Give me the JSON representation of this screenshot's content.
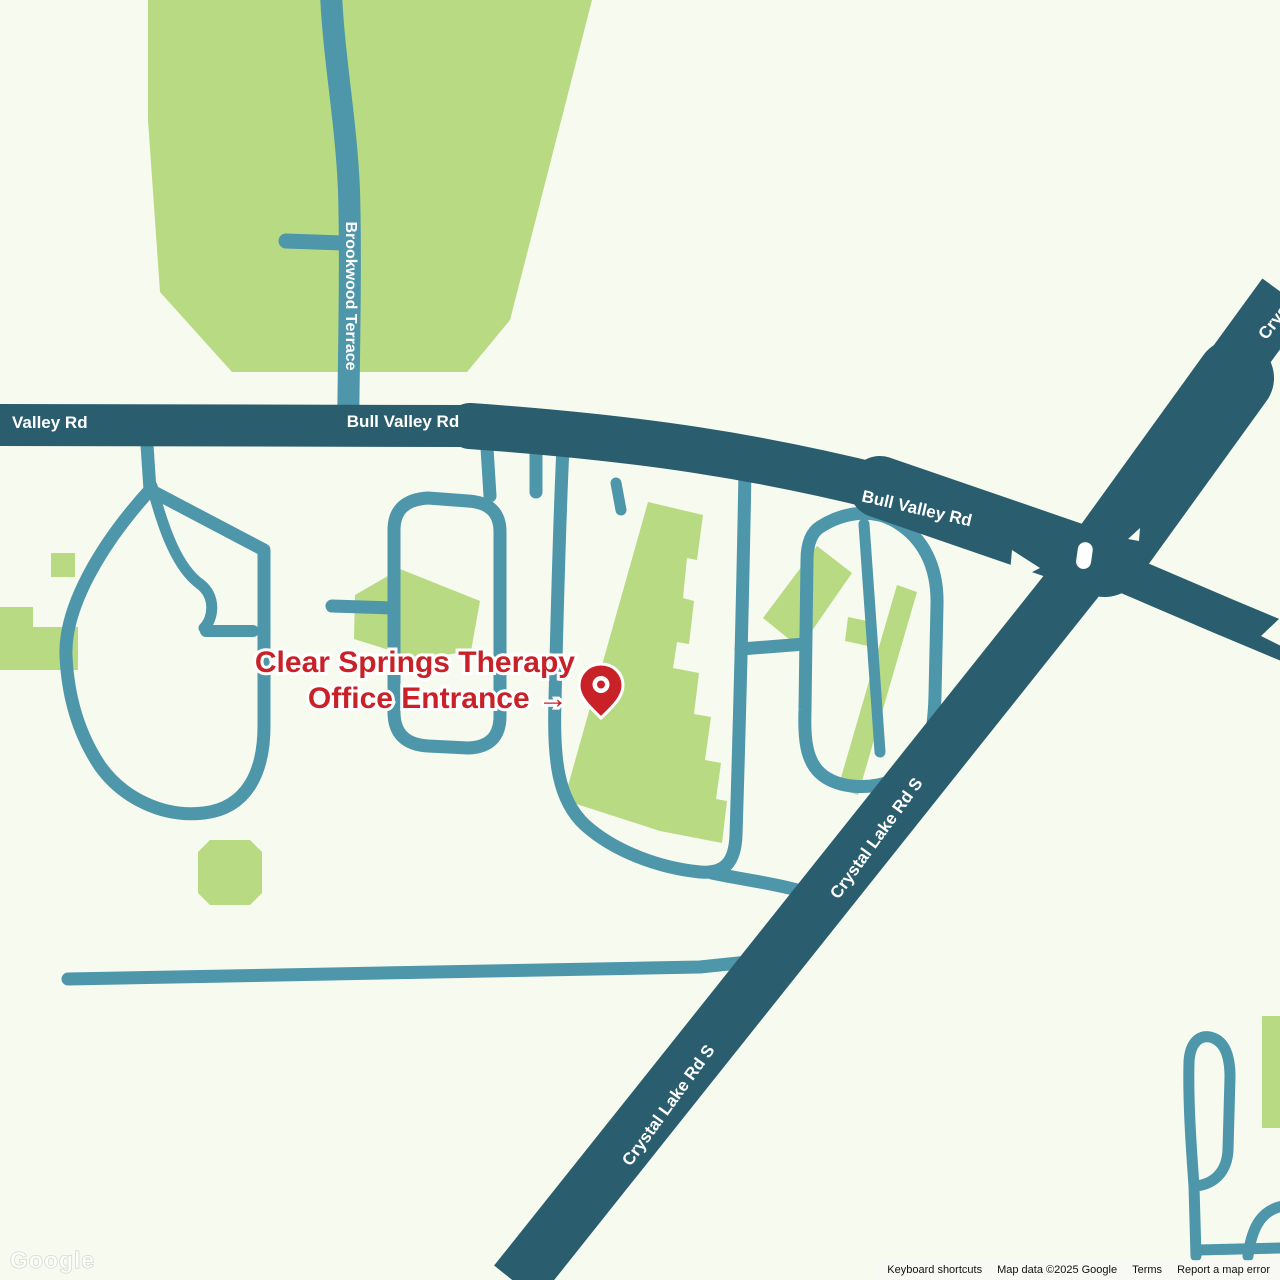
{
  "map": {
    "colors": {
      "background": "#f7faee",
      "park_green": "#b8da82",
      "major_road": "#2a5d6e",
      "minor_road": "#4e96aa",
      "annotation_red": "#c92128",
      "label_white": "#ffffff"
    },
    "road_labels": [
      {
        "id": "valley-rd",
        "text": "Valley Rd"
      },
      {
        "id": "bull-valley-rd-west",
        "text": "Bull Valley Rd"
      },
      {
        "id": "bull-valley-rd-east",
        "text": "Bull Valley Rd"
      },
      {
        "id": "brookwood-terrace",
        "text": "Brookwood Terrace"
      },
      {
        "id": "crystal-lake-rd-s-upper",
        "text": "Crystal Lake Rd S"
      },
      {
        "id": "crystal-lake-rd-s-lower",
        "text": "Crystal Lake Rd S"
      },
      {
        "id": "crystal-partial",
        "text": "Crystal"
      }
    ],
    "annotation": {
      "line1": "Clear Springs Therapy",
      "line2": "Office Entrance →"
    },
    "marker": {
      "name": "destination-pin",
      "color": "#c92128"
    },
    "watermark": "Google"
  },
  "attribution": {
    "keyboard_shortcuts": "Keyboard shortcuts",
    "map_data": "Map data ©2025 Google",
    "terms": "Terms",
    "report": "Report a map error"
  }
}
